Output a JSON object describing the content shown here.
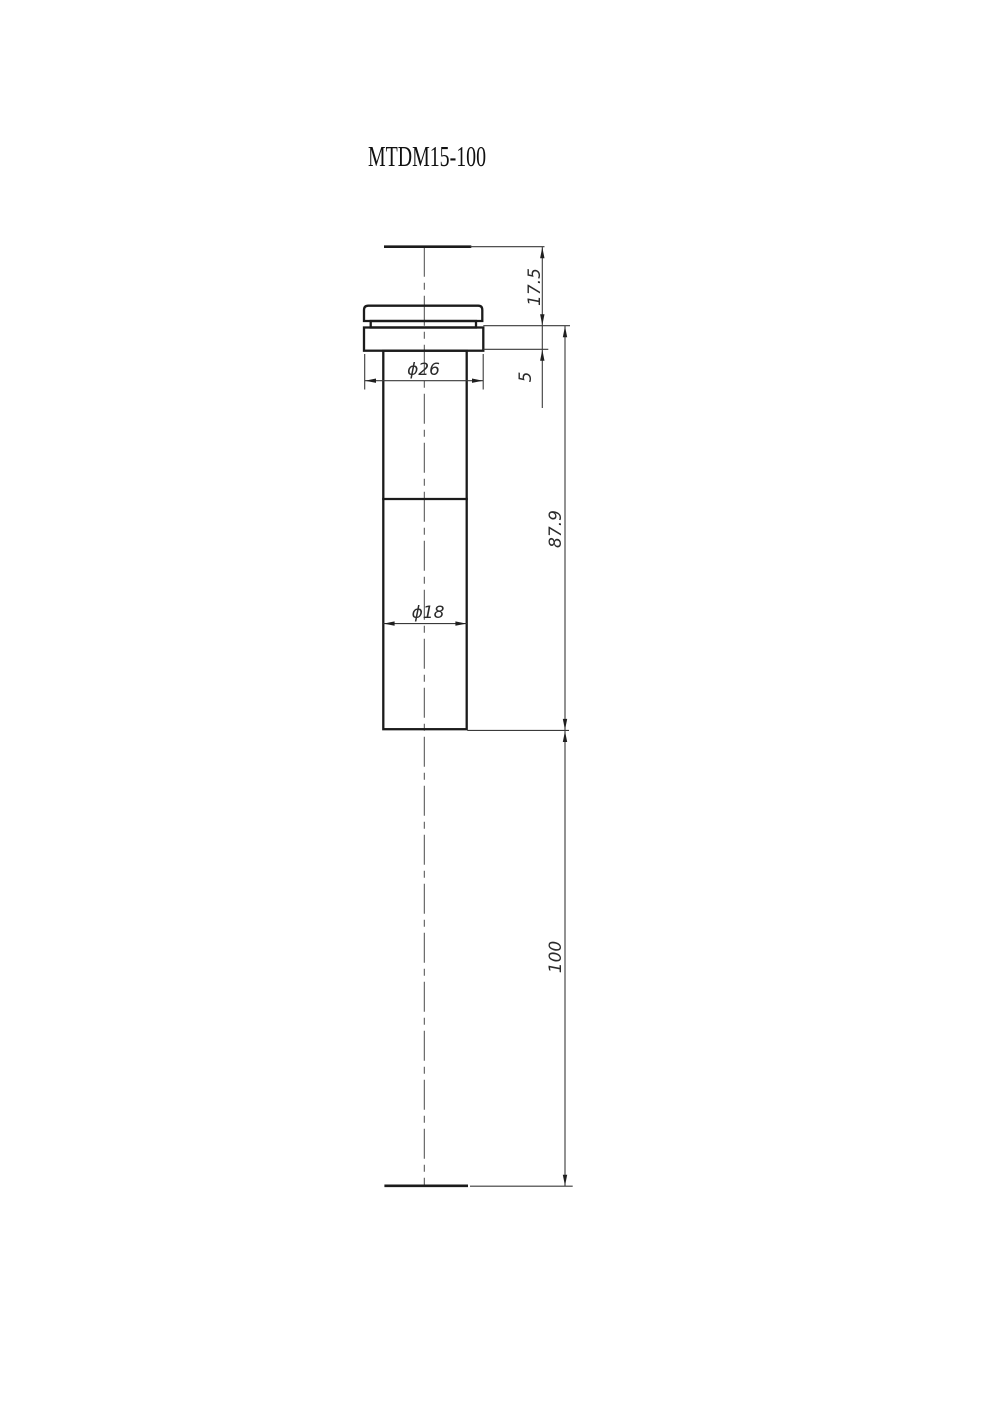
{
  "title": "MTDM15-100",
  "dims": {
    "top_to_flange": "17.5",
    "flange_thickness": "5",
    "body_length": "87.9",
    "overall_length": "100",
    "flange_diameter": "ϕ26",
    "tube_diameter": "ϕ18"
  }
}
